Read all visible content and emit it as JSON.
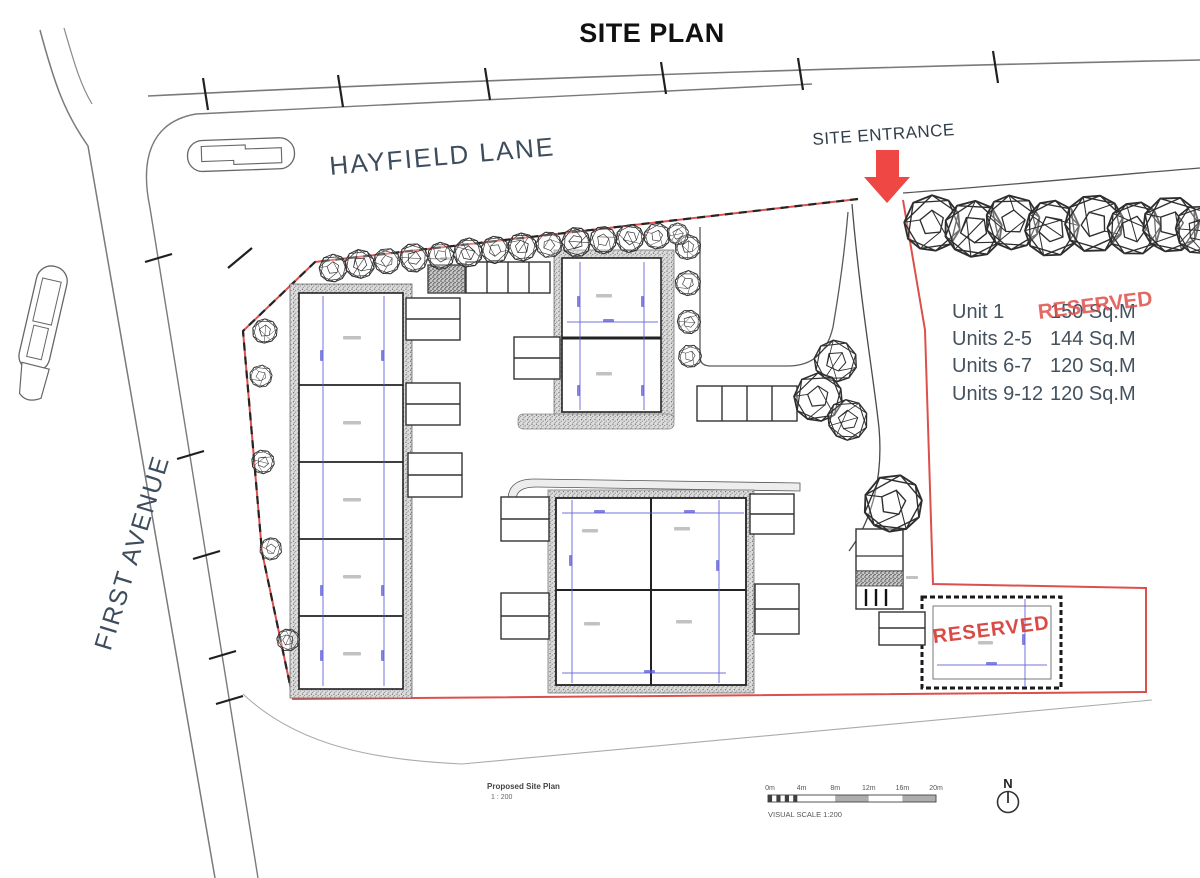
{
  "title": "SITE PLAN",
  "labels": {
    "hayfield_lane": "HAYFIELD LANE",
    "first_avenue": "FIRST AVENUE",
    "site_entrance": "SITE ENTRANCE"
  },
  "legend": {
    "rows": [
      {
        "unit": "Unit 1",
        "area": "150 Sq.M",
        "overlay": "RESERVED"
      },
      {
        "unit": "Units 2-5",
        "area": "144 Sq.M"
      },
      {
        "unit": "Units 6-7",
        "area": "120 Sq.M"
      },
      {
        "unit": "Units 9-12",
        "area": "120 Sq.M"
      }
    ]
  },
  "reserved_plot": {
    "stamp": "RESERVED"
  },
  "scale_bar": {
    "ticks": [
      "0m",
      "4m",
      "8m",
      "12m",
      "16m",
      "20m"
    ],
    "caption": "VISUAL SCALE 1:200"
  },
  "title_block": {
    "name": "Proposed Site Plan",
    "scale": "1 : 200"
  },
  "north": {
    "label": "N"
  },
  "colors": {
    "boundary_red": "#dd4f4c",
    "arrow_red": "#ef4743",
    "reserved_red": "#d84b46",
    "dimension_blue": "#5b5bd6",
    "label_slate": "#3d4d5d"
  }
}
